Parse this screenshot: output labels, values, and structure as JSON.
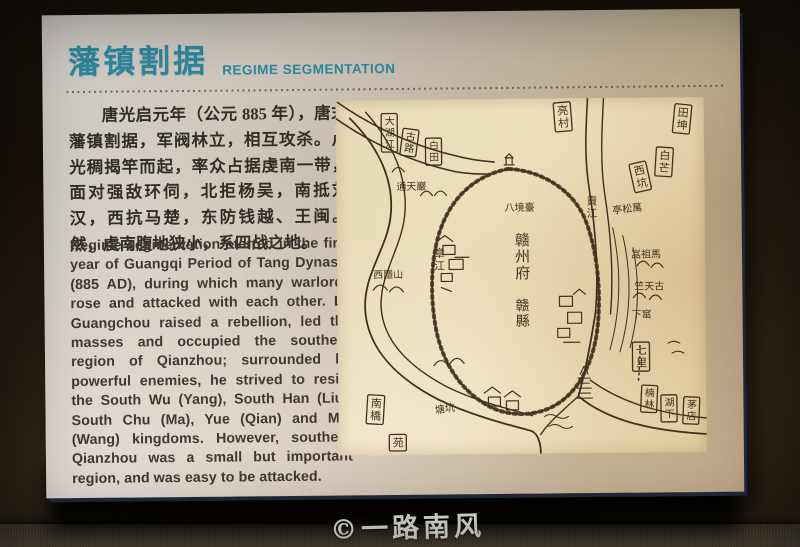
{
  "panel": {
    "title_zh": "藩镇割据",
    "title_en": "REGIME SEGMENTATION",
    "accent_color": "#2b8aa2",
    "paragraph_zh": "唐光启元年（公元 885 年），唐末藩镇割据，军阀林立，相互攻杀。卢光稠揭竿而起，率众占据虔南一带，面对强敌环伺，北拒杨吴，南抵刘汉，西抗马楚，东防钱越、王闽。然，虔南腹地狭小，系四战之地。",
    "paragraph_en": "Regime segmentation started in the first year of Guangqi Period of Tang Dynasty (885 AD), during which many warlords rose and attacked with each other. Lu Guangchou raised a rebellion, led the masses and occupied the southern region of Qianzhou; surrounded by powerful enemies, he strived to resist the South Wu (Yang), South Han (Liu), South Chu (Ma), Yue (Qian) and Min (Wang) kingdoms. However, southern Qianzhou was a small but important region, and was easy to be attacked."
  },
  "map": {
    "ink_color": "#42301e",
    "paper_color": "#e9dab8",
    "city_label": "赣州府",
    "county_label": "赣縣",
    "river_west": "章江",
    "river_east": "貢江",
    "labels": [
      {
        "t": "亮村",
        "x": 219,
        "y": 4,
        "o": "v",
        "b": true,
        "fs": 11,
        "r": -4
      },
      {
        "t": "田坤",
        "x": 341,
        "y": 6,
        "o": "v",
        "b": true,
        "fs": 11,
        "r": 6
      },
      {
        "t": "白芒",
        "x": 322,
        "y": 49,
        "o": "v",
        "b": true,
        "fs": 11,
        "r": 4
      },
      {
        "t": "西坑",
        "x": 294,
        "y": 66,
        "o": "v",
        "b": true,
        "fs": 11,
        "r": -12
      },
      {
        "t": "大湖江",
        "x": 47,
        "y": 13,
        "o": "v",
        "b": true,
        "fs": 10,
        "r": 0
      },
      {
        "t": "古路",
        "x": 69,
        "y": 28,
        "o": "v",
        "b": true,
        "fs": 10,
        "r": 8
      },
      {
        "t": "白田",
        "x": 91,
        "y": 38,
        "o": "v",
        "b": true,
        "fs": 10,
        "r": 0
      },
      {
        "t": "南橋",
        "x": 31,
        "y": 294,
        "o": "v",
        "b": true,
        "fs": 11,
        "r": 4
      },
      {
        "t": "苑",
        "x": 52,
        "y": 334,
        "o": "v",
        "b": true,
        "fs": 11,
        "r": 0
      },
      {
        "t": "七里",
        "x": 296,
        "y": 244,
        "o": "v",
        "b": true,
        "fs": 11,
        "r": 0
      },
      {
        "t": "楠林",
        "x": 305,
        "y": 287,
        "o": "v",
        "b": true,
        "fs": 10,
        "r": 3
      },
      {
        "t": "湖下",
        "x": 324,
        "y": 297,
        "o": "v",
        "b": true,
        "fs": 10,
        "r": 0
      },
      {
        "t": "茅店",
        "x": 347,
        "y": 299,
        "o": "v",
        "b": true,
        "fs": 10,
        "r": 3
      },
      {
        "t": "亭松萬",
        "x": 276,
        "y": 116,
        "o": "h",
        "b": false,
        "fs": 10,
        "r": -6
      },
      {
        "t": "嵓祖馬",
        "x": 294,
        "y": 160,
        "o": "h",
        "b": false,
        "fs": 10,
        "r": 0
      },
      {
        "t": "竺天古",
        "x": 297,
        "y": 192,
        "o": "h",
        "b": false,
        "fs": 10,
        "r": 0
      },
      {
        "t": "下窰",
        "x": 294,
        "y": 220,
        "o": "h",
        "b": false,
        "fs": 10,
        "r": 0
      },
      {
        "t": "塘坑",
        "x": 97,
        "y": 314,
        "o": "h",
        "b": false,
        "fs": 10,
        "r": -8
      },
      {
        "t": "通天巖",
        "x": 60,
        "y": 90,
        "o": "h",
        "b": false,
        "fs": 10,
        "r": 0
      },
      {
        "t": "西隱山",
        "x": 36,
        "y": 178,
        "o": "h",
        "b": false,
        "fs": 10,
        "r": 0
      },
      {
        "t": "章江",
        "x": 95,
        "y": 145,
        "o": "v",
        "b": false,
        "fs": 11,
        "r": 0
      },
      {
        "t": "貢江",
        "x": 248,
        "y": 94,
        "o": "v",
        "b": false,
        "fs": 11,
        "r": 0
      },
      {
        "t": "八境臺",
        "x": 168,
        "y": 112,
        "o": "h",
        "b": false,
        "fs": 10,
        "r": 0
      },
      {
        "t": "赣州府",
        "x": 176,
        "y": 130,
        "o": "v",
        "b": false,
        "fs": 15,
        "r": 0
      },
      {
        "t": "赣縣",
        "x": 176,
        "y": 196,
        "o": "v",
        "b": false,
        "fs": 14,
        "r": 0
      }
    ]
  },
  "watermark": "©一路南风"
}
